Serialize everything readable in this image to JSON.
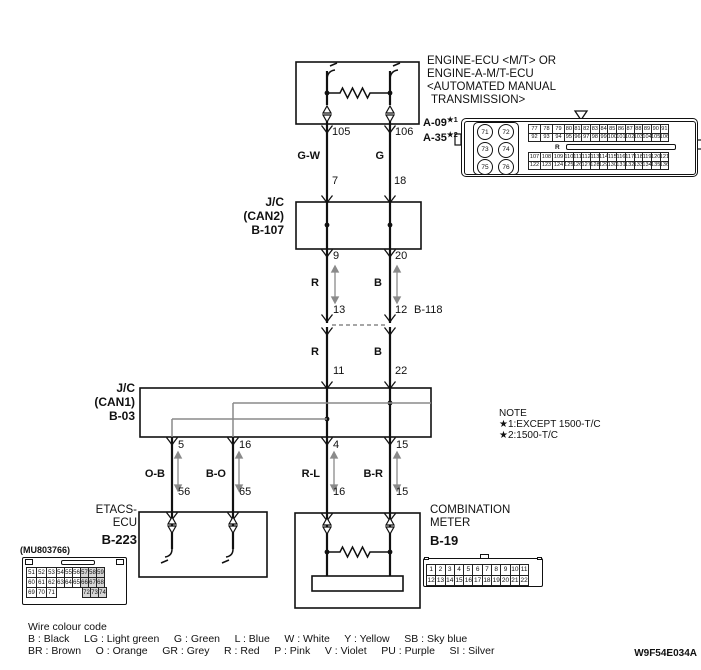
{
  "engine_ecu": {
    "title1": "ENGINE-ECU <M/T> OR",
    "title2": "ENGINE-A-M/T-ECU",
    "title3": "<AUTOMATED MANUAL",
    "title4": " TRANSMISSION>",
    "conn1": "A-09",
    "conn1_note": "★1",
    "conn2": "A-35",
    "conn2_note": "★2",
    "pin_left": "105",
    "pin_right": "106"
  },
  "jc_can2": {
    "line1": "J/C",
    "line2": "(CAN2)",
    "line3": "B-107",
    "pin_in_left": "7",
    "pin_in_right": "18",
    "pin_out_left": "9",
    "pin_out_right": "20"
  },
  "b118": {
    "pin_left": "13",
    "pin_right": "12",
    "label": "B-118"
  },
  "jc_can1": {
    "line1": "J/C",
    "line2": "(CAN1)",
    "line3": "B-03",
    "pin_in_left": "11",
    "pin_in_right": "22",
    "pin_out_1": "5",
    "pin_out_2": "16",
    "pin_out_3": "4",
    "pin_out_4": "15"
  },
  "etacs": {
    "line1": "ETACS-",
    "line2": "ECU",
    "line3": "B-223",
    "part_no": "(MU803766)",
    "pin_1": "56",
    "pin_2": "65"
  },
  "meter": {
    "line1": "COMBINATION",
    "line2": "METER",
    "line3": "B-19",
    "pin_1": "16",
    "pin_2": "15"
  },
  "wire_labels": {
    "gw": "G-W",
    "g": "G",
    "r1": "R",
    "b1": "B",
    "r2": "R",
    "b2": "B",
    "ob": "O-B",
    "bo": "B-O",
    "rl": "R-L",
    "br": "B-R"
  },
  "note": {
    "title": "NOTE",
    "item1": "★1:EXCEPT 1500-T/C",
    "item2": "★2:1500-T/C"
  },
  "footer": {
    "title": "Wire colour code",
    "line1": "B : Black     LG : Light green     G : Green     L : Blue     W : White     Y : Yellow     SB : Sky blue",
    "line2": "BR : Brown     O : Orange     GR : Grey     R : Red     P : Pink     V : Violet     PU : Purple     SI : Silver",
    "doc_code": "W9F54E034A"
  },
  "connectors": {
    "engine": {
      "circles": [
        "71",
        "72",
        "73",
        "74",
        "75",
        "76"
      ],
      "key_label": "R",
      "row1": [
        {
          "t": "77",
          "c": "w"
        },
        {
          "t": "78",
          "c": "w"
        },
        {
          "t": "79",
          "c": "w"
        },
        "80",
        "81",
        "82",
        "83",
        "84",
        "85",
        "86",
        "87",
        "88",
        "89",
        "90",
        "91"
      ],
      "row2": [
        {
          "t": "92",
          "c": "w"
        },
        {
          "t": "93",
          "c": "w"
        },
        {
          "t": "94",
          "c": "w"
        },
        "95",
        "96",
        "97",
        "98",
        "99",
        "100",
        "101",
        "102",
        "103",
        "104",
        "105",
        "106"
      ],
      "row3": [
        {
          "t": "107",
          "c": "w"
        },
        {
          "t": "108",
          "c": "w"
        },
        {
          "t": "109",
          "c": "w"
        },
        "110",
        "111",
        "112",
        "113",
        "114",
        "115",
        "116",
        "117",
        "118",
        "119",
        "120",
        "121"
      ],
      "row4": [
        {
          "t": "122",
          "c": "w"
        },
        {
          "t": "123",
          "c": "w"
        },
        {
          "t": "124",
          "c": "w"
        },
        "125",
        "126",
        "127",
        "128",
        "129",
        "130",
        "131",
        "132",
        "133",
        "134",
        "135",
        "136"
      ]
    },
    "etacs": {
      "row1": [
        {
          "t": "51",
          "c": "w"
        },
        {
          "t": "52",
          "c": "w"
        },
        {
          "t": "53",
          "c": "w"
        },
        "54",
        "55",
        "56",
        {
          "t": "57",
          "c": "gy"
        },
        {
          "t": "58",
          "c": "gy"
        },
        {
          "t": "59",
          "c": "gy"
        }
      ],
      "row2": [
        {
          "t": "60",
          "c": "w"
        },
        {
          "t": "61",
          "c": "w"
        },
        {
          "t": "62",
          "c": "w"
        },
        "63",
        "64",
        "65",
        {
          "t": "66",
          "c": "gy"
        },
        {
          "t": "67",
          "c": "gy"
        },
        {
          "t": "68",
          "c": "gy"
        }
      ],
      "row3": [
        {
          "t": "69",
          "c": "w"
        },
        {
          "t": "70",
          "c": "w"
        },
        {
          "t": "71",
          "c": "w"
        },
        {
          "t": "",
          "c": "gap"
        },
        {
          "t": "72",
          "c": "gy"
        },
        {
          "t": "73",
          "c": "gy"
        },
        {
          "t": "74",
          "c": "gy"
        }
      ]
    },
    "b19": {
      "row1": [
        "1",
        "2",
        "3",
        "4",
        "5",
        "6",
        "7",
        "8",
        "9",
        "10",
        "11"
      ],
      "row2": [
        "12",
        "13",
        "14",
        "15",
        "16",
        "17",
        "18",
        "19",
        "20",
        "21",
        "22"
      ]
    }
  }
}
